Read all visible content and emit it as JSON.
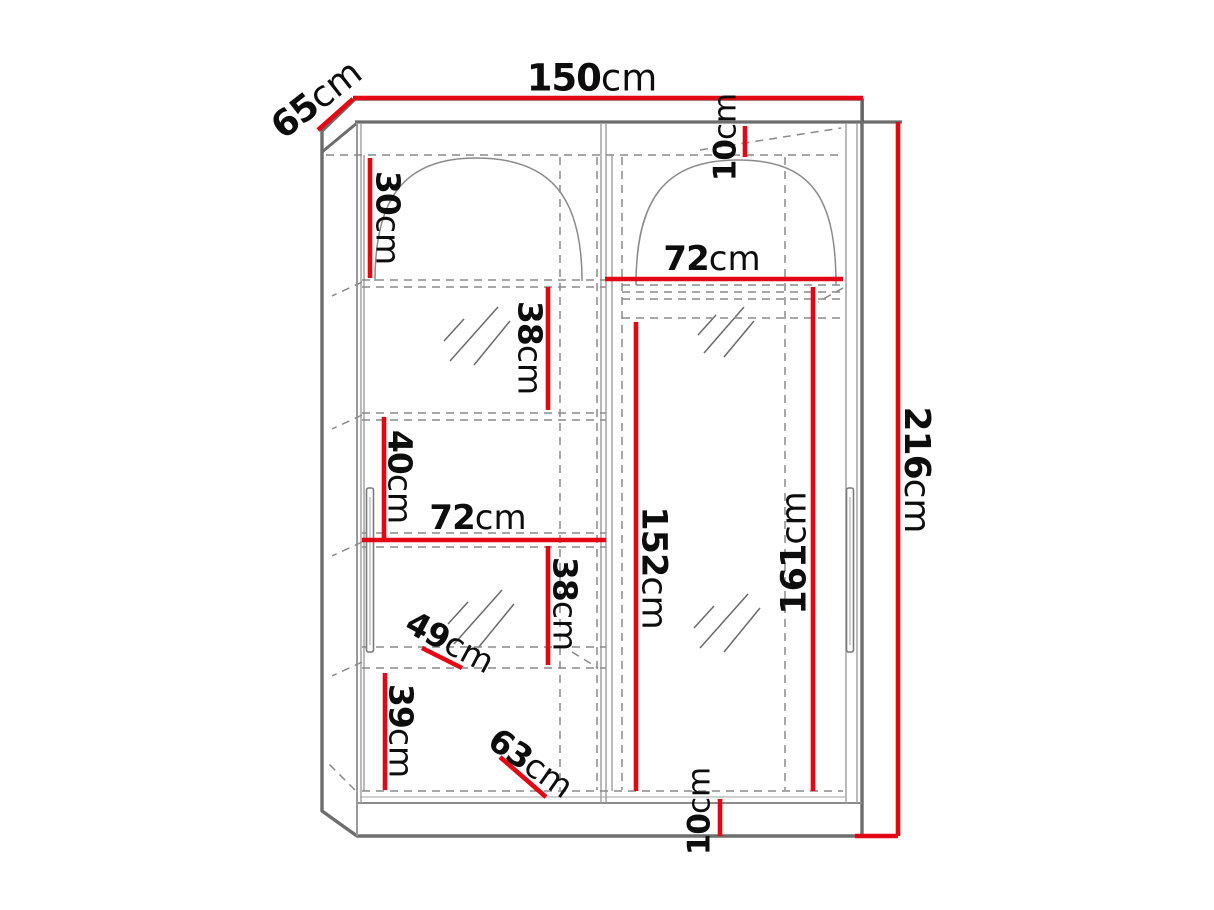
{
  "diagram": {
    "kind": "furniture dimension drawing",
    "subject": "two-door sliding wardrobe, front view with shelf layout",
    "unit": "cm",
    "colors": {
      "dimension_line": "#e30613",
      "outline": "#6d6d6d",
      "hidden_line": "#8a8a8a",
      "label_text": "#0d0d0d",
      "background": "#ffffff"
    }
  },
  "labels": {
    "overall_width": {
      "value": "150",
      "unit": "cm"
    },
    "overall_depth": {
      "value": "65",
      "unit": "cm"
    },
    "overall_height": {
      "value": "216",
      "unit": "cm"
    },
    "top_clearance": {
      "value": "10",
      "unit": "cm"
    },
    "right_section_width": {
      "value": "72",
      "unit": "cm"
    },
    "top_shelf_height": {
      "value": "30",
      "unit": "cm"
    },
    "upper_compartment": {
      "value": "38",
      "unit": "cm"
    },
    "middle_compartment": {
      "value": "40",
      "unit": "cm"
    },
    "left_section_width": {
      "value": "72",
      "unit": "cm"
    },
    "lower_compartment": {
      "value": "38",
      "unit": "cm"
    },
    "upper_shelf_depth": {
      "value": "49",
      "unit": "cm"
    },
    "bottom_compartment": {
      "value": "39",
      "unit": "cm"
    },
    "lower_shelf_depth": {
      "value": "63",
      "unit": "cm"
    },
    "plinth_height": {
      "value": "10",
      "unit": "cm"
    },
    "left_hanging_height": {
      "value": "152",
      "unit": "cm"
    },
    "right_hanging_height": {
      "value": "161",
      "unit": "cm"
    }
  }
}
